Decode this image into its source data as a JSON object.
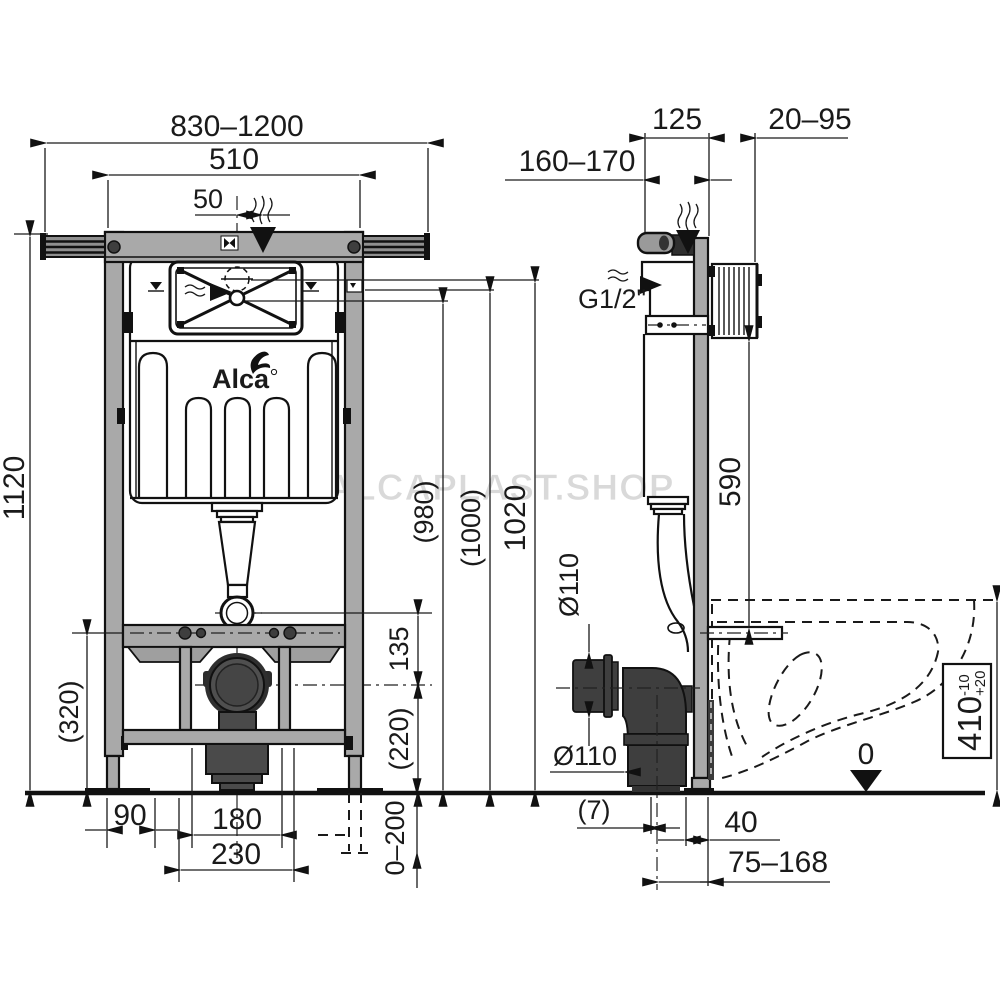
{
  "watermark": {
    "text": "ALCAPLAST.SHOP"
  },
  "logo": {
    "brand": "Alca"
  },
  "front_view": {
    "dims": {
      "overall_width": "830–1200",
      "frame_width": "510",
      "flush_offset": "50",
      "frame_height": "1120",
      "base_height": "(320)",
      "foot_inset": "90",
      "outlet_width": "180",
      "outlet_frame_width": "230",
      "outlet_drop": "135",
      "outlet_center_height": "(220)",
      "leg_adjust": "0–200",
      "ref_980": "(980)",
      "ref_1000": "(1000)",
      "ref_1020": "1020"
    }
  },
  "side_view": {
    "dims": {
      "install_depth": "160–170",
      "frame_depth": "125",
      "wall_distance": "20–95",
      "water_connection": "G1/2\"",
      "cistern_bottom_height": "590",
      "waste_pipe_dia": "Ø110",
      "waste_outlet_dia": "Ø110",
      "axis_offset": "(7)",
      "profile_size": "40",
      "outlet_distance": "75–168",
      "bowl_height": "410",
      "bowl_tol_plus": "+20",
      "bowl_tol_minus": "-10",
      "floor_level": "0"
    }
  }
}
